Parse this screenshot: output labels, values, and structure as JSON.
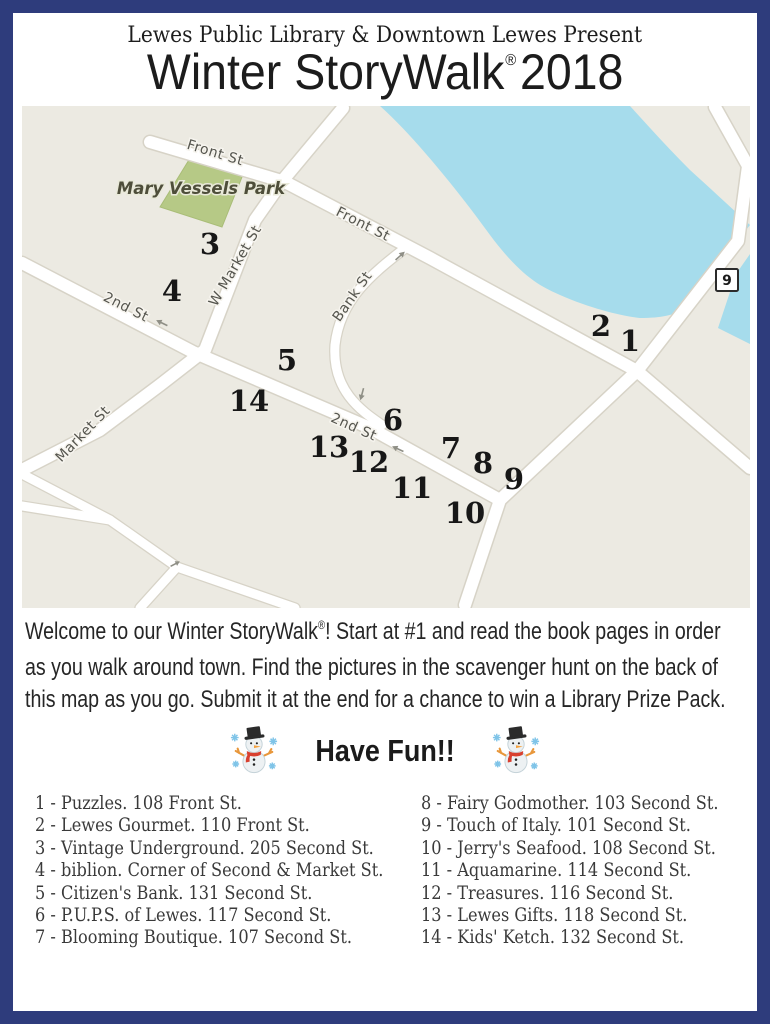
{
  "header": {
    "presenter": "Lewes Public Library & Downtown Lewes Present",
    "title": "Winter StoryWalk",
    "registered_mark": "®",
    "year": "2018"
  },
  "map": {
    "park_label": "Mary Vessels Park",
    "route_badge": "9",
    "labels": {
      "front_st_upper": "Front St",
      "front_st_lower": "Front St",
      "second_st_left": "2nd St",
      "second_st_mid": "2nd St",
      "w_market_st": "W Market St",
      "bank_st": "Bank St",
      "market_st": "Market St"
    },
    "markers": [
      "1",
      "2",
      "3",
      "4",
      "5",
      "6",
      "7",
      "8",
      "9",
      "10",
      "11",
      "12",
      "13",
      "14"
    ],
    "colors": {
      "background": "#eceae2",
      "water": "#a6dcec",
      "park": "#b6c986",
      "street": "#ffffff"
    }
  },
  "welcome": {
    "line1_pre": "Welcome to our Winter StoryWalk",
    "registered_mark": "®",
    "line1_post": "! Start at #1 and read the book pages in order",
    "line2": "as you walk around town. Find the pictures in the scavenger hunt on the back of",
    "line3": "this map as you go. Submit it at the end for a chance to win a Library Prize Pack."
  },
  "have_fun": {
    "label": "Have Fun!!",
    "icon": "snowman-with-snowflakes"
  },
  "directory": {
    "left": [
      "1 - Puzzles. 108 Front St.",
      "2 - Lewes Gourmet. 110 Front St.",
      "3 - Vintage Underground. 205 Second St.",
      "4 - biblion. Corner of Second & Market St.",
      "5 - Citizen's Bank. 131 Second St.",
      "6 - P.U.P.S. of Lewes. 117 Second St.",
      "7 - Blooming Boutique. 107 Second St."
    ],
    "right": [
      "8 - Fairy Godmother. 103 Second St.",
      "9 - Touch of Italy. 101 Second St.",
      "10 - Jerry's Seafood. 108 Second St.",
      "11 - Aquamarine. 114 Second St.",
      "12 - Treasures. 116 Second St.",
      "13 - Lewes Gifts. 118 Second St.",
      "14 - Kids' Ketch. 132 Second St."
    ]
  },
  "page": {
    "border_color": "#2e3c7c"
  }
}
